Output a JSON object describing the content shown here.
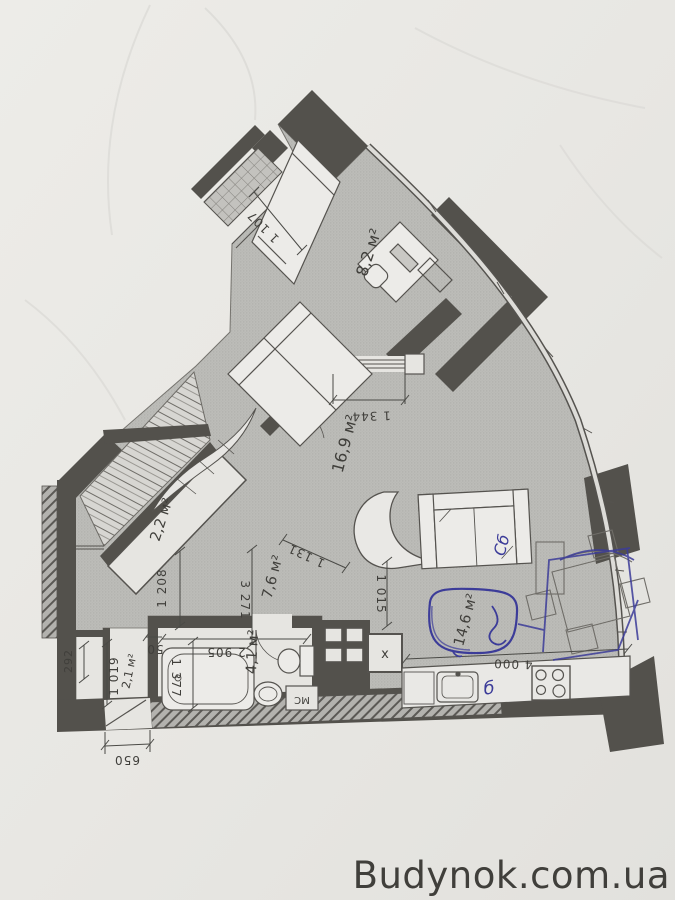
{
  "watermark": {
    "text": "Budynok.com.ua",
    "color": "#2b3da7"
  },
  "pen_color": "#3c3c99",
  "rooms": [
    {
      "id": "bedroom-upper",
      "area_label": "8,2 м²"
    },
    {
      "id": "bedroom-main",
      "area_label": "16,9 м²"
    },
    {
      "id": "closet",
      "area_label": "2,2 м²"
    },
    {
      "id": "hallway",
      "area_label": "7,6 м²"
    },
    {
      "id": "bathroom",
      "area_label": "4,1 м²"
    },
    {
      "id": "kitchen-living",
      "area_label": "14,6 м²"
    },
    {
      "id": "entry-closet",
      "area_label": "2,1 м²"
    }
  ],
  "dims": [
    {
      "id": "dim-1107",
      "text": "1 107"
    },
    {
      "id": "dim-1344",
      "text": "1 344"
    },
    {
      "id": "dim-1131",
      "text": "1 131"
    },
    {
      "id": "dim-1015",
      "text": "1 015"
    },
    {
      "id": "dim-1208",
      "text": "1 208"
    },
    {
      "id": "dim-3271",
      "text": "3 271"
    },
    {
      "id": "dim-2905",
      "text": "2 905"
    },
    {
      "id": "dim-50",
      "text": "50"
    },
    {
      "id": "dim-1377",
      "text": "1 377"
    },
    {
      "id": "dim-1019",
      "text": "1 019"
    },
    {
      "id": "dim-292",
      "text": "292"
    },
    {
      "id": "dim-650",
      "text": "650"
    },
    {
      "id": "dim-4000",
      "text": "4 000"
    }
  ],
  "fixtures": {
    "washing_machine": "МС",
    "shaft_mark": "х"
  },
  "annotations": {
    "sofa_note": "Сб",
    "counter_note": "б"
  }
}
